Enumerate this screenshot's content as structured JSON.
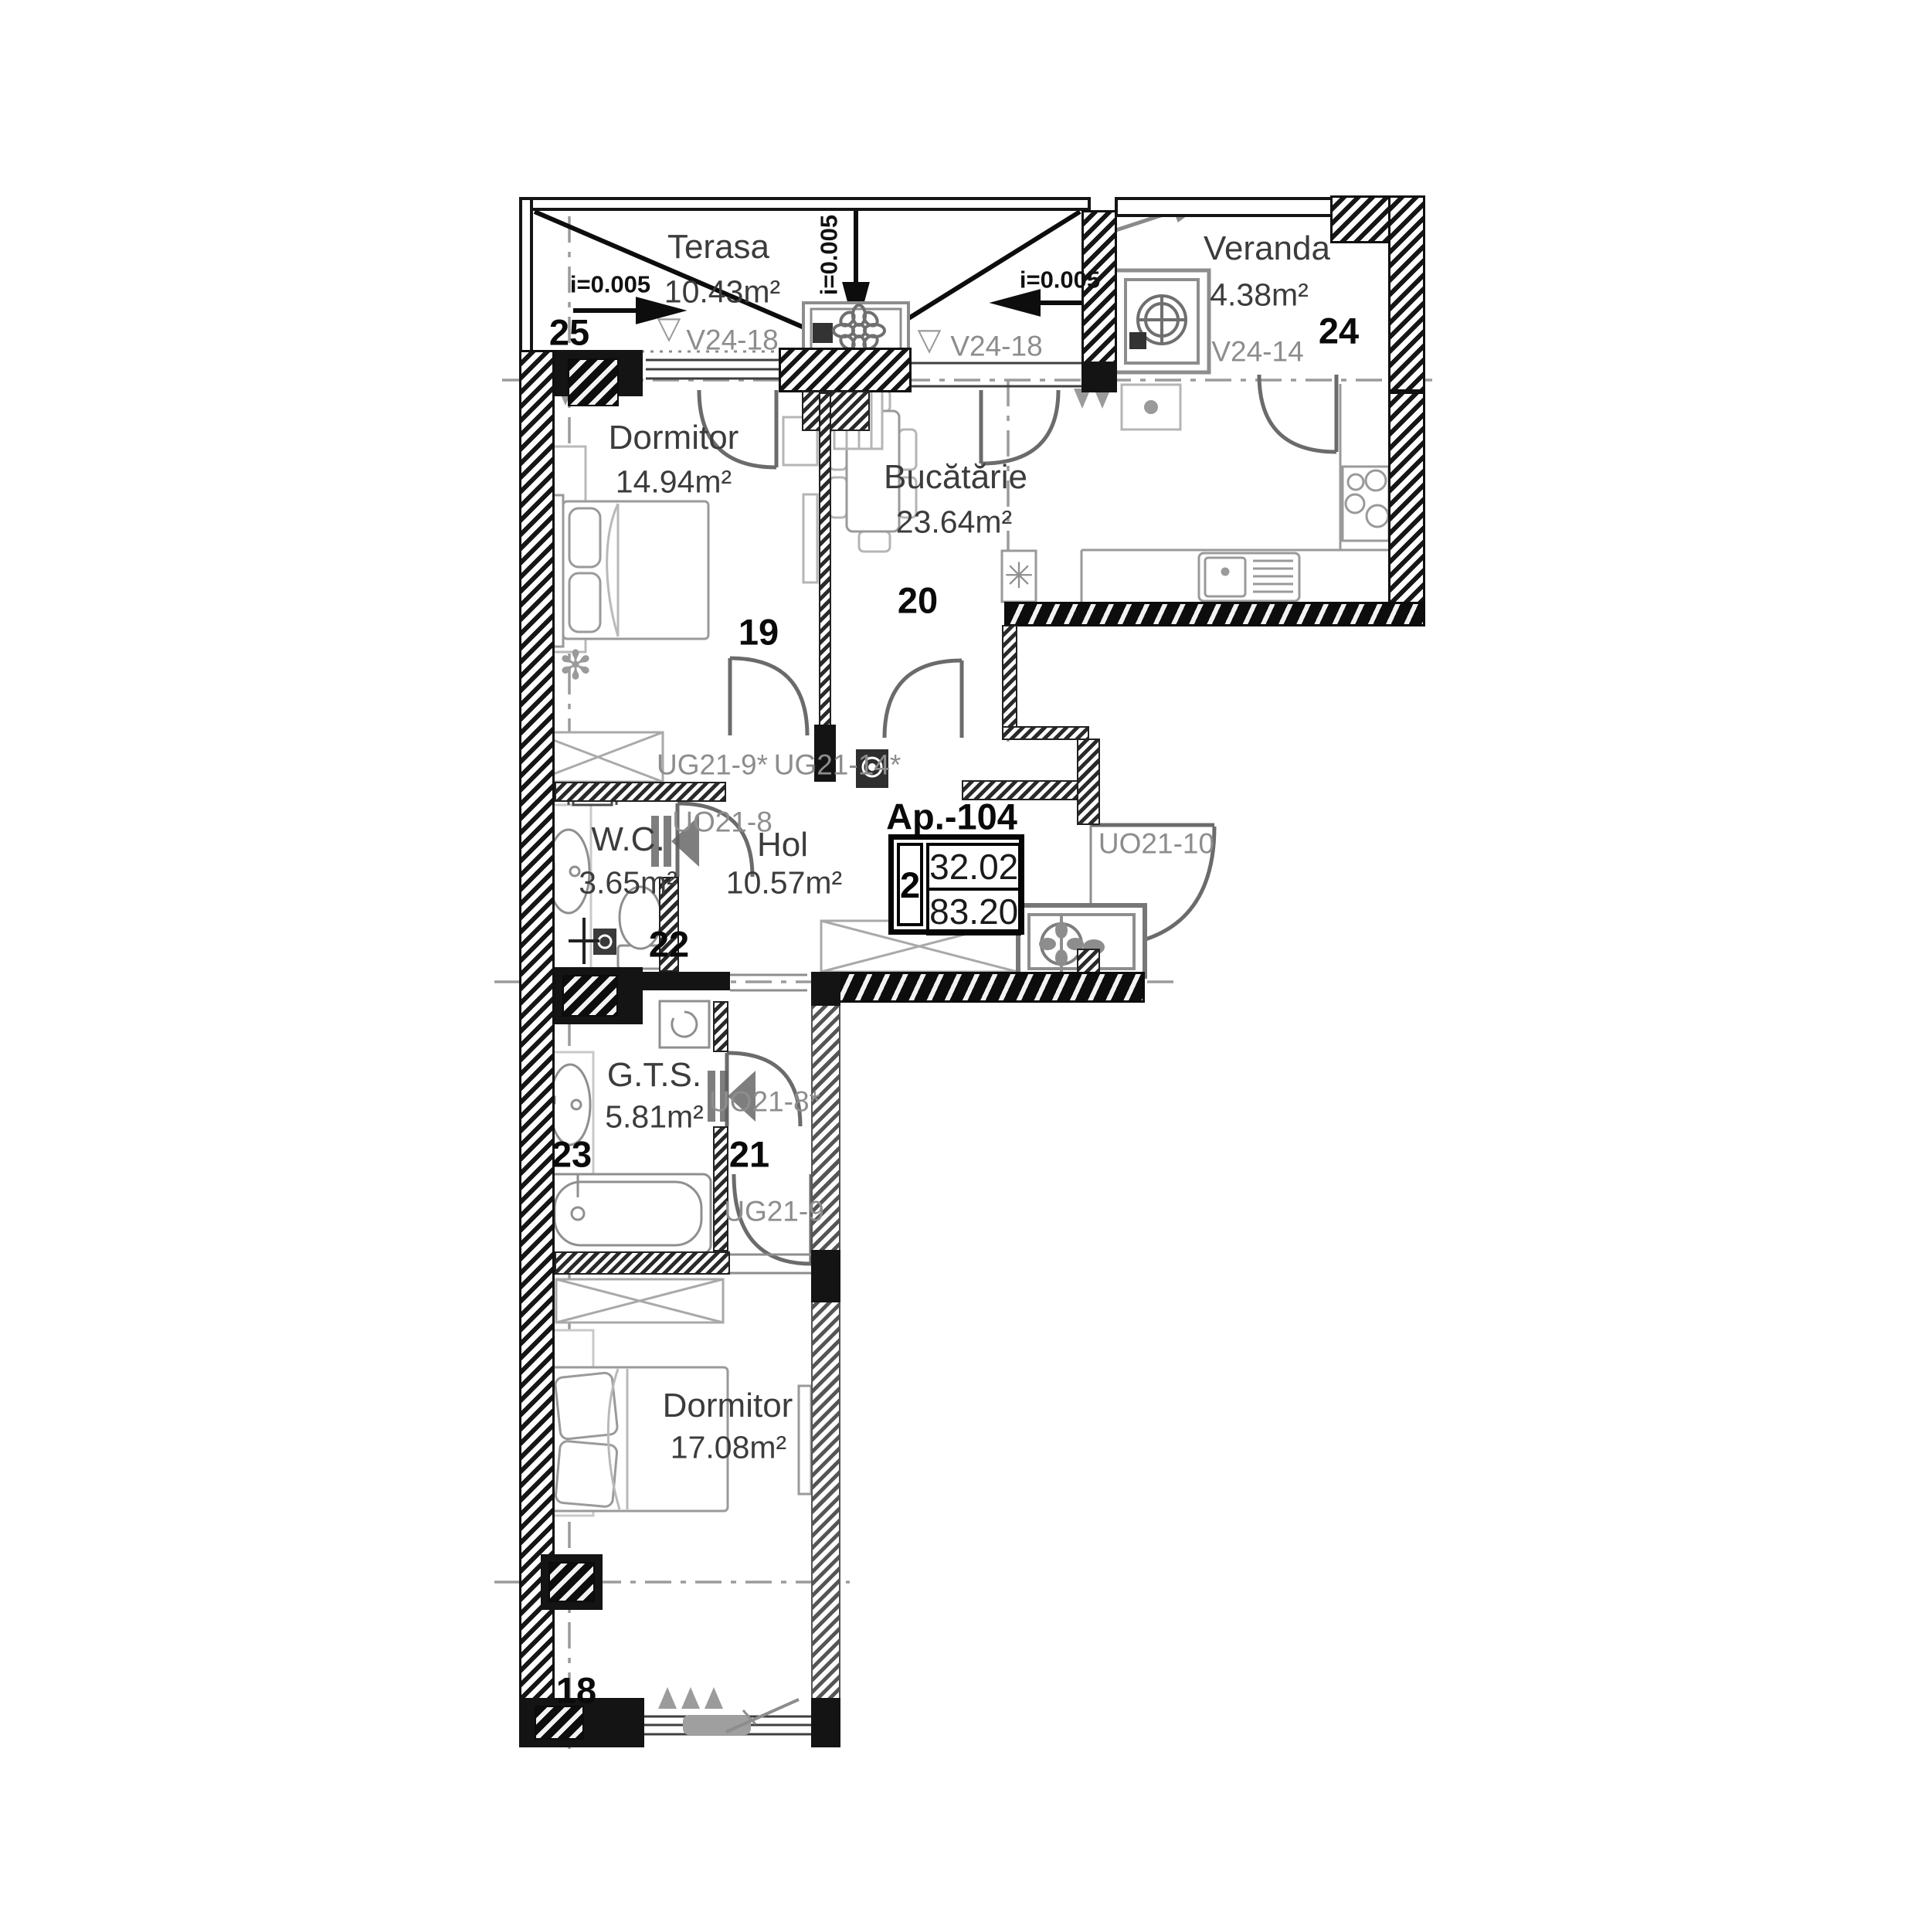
{
  "apartment_box": {
    "title": "Ap.-104",
    "room_count": "2",
    "useful_area": "32.02",
    "total_area": "83.20"
  },
  "rooms": {
    "terasa": {
      "name": "Terasa",
      "area": "10.43m²",
      "number": "25"
    },
    "veranda": {
      "name": "Veranda",
      "area": "4.38m²",
      "number": "24"
    },
    "dormitor19": {
      "name": "Dormitor",
      "area": "14.94m²",
      "number": "19"
    },
    "bucatarie": {
      "name": "Bucătărie",
      "area": "23.64m²",
      "number": "20"
    },
    "wc": {
      "name": "W.C.",
      "area": "3.65m²",
      "number": "22"
    },
    "hol": {
      "name": "Hol",
      "area": "10.57m²"
    },
    "gts": {
      "name": "G.T.S.",
      "area": "5.81m²",
      "number": "23"
    },
    "corridor21": {
      "number": "21"
    },
    "dormitor18": {
      "name": "Dormitor",
      "area": "17.08m²",
      "number": "18"
    }
  },
  "slopes": {
    "left": "i=0.005",
    "middle": "i=0.005",
    "right": "i=0.005"
  },
  "openings": {
    "terasa_left": "V24-18",
    "terasa_right": "V24-18",
    "veranda": "V24-14",
    "dormitor19_door": "UG21-9*",
    "bucatarie_door": "UG21-14*",
    "wc_door": "UO21-8",
    "entrance_door": "UO21-10",
    "gts_door": "UO21-8*",
    "dormitor18_door": "UG21-9"
  },
  "markers": {
    "level_triangle": "▽",
    "plant": "✻"
  },
  "colors": {
    "wall": "#141414",
    "furniture": "#9a9a9a",
    "label_gray": "#8d8d8d",
    "arc": "#6b6b6b"
  }
}
